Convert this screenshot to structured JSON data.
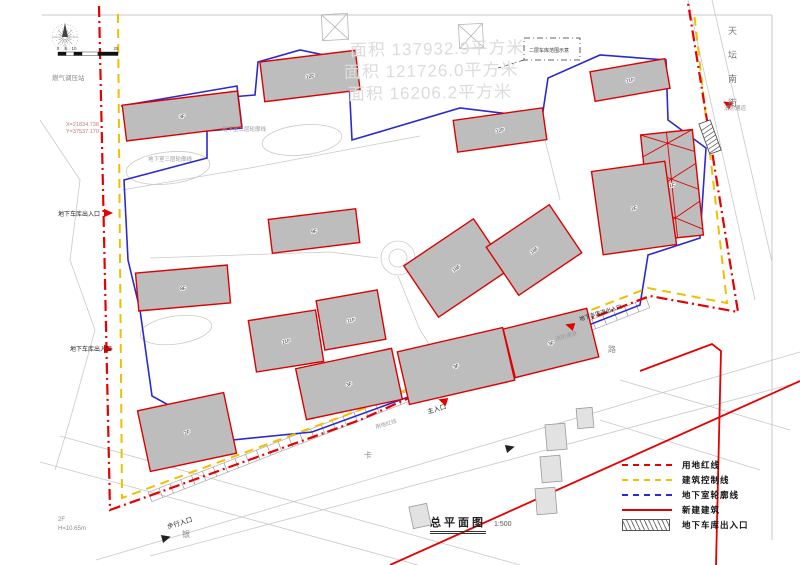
{
  "drawing": {
    "title": "总平面图",
    "scale": "1:500"
  },
  "legend": {
    "items": [
      {
        "label": "用地红线",
        "style": "dash-dot",
        "color": "#e60000"
      },
      {
        "label": "建筑控制线",
        "style": "dashed",
        "color": "#eec000"
      },
      {
        "label": "地下室轮廓线",
        "style": "dashed",
        "color": "#2a2ad0"
      },
      {
        "label": "新建建筑",
        "style": "solid",
        "color": "#e60000"
      },
      {
        "label": "地下车库出入口",
        "style": "hatch",
        "color": "#444444"
      }
    ]
  },
  "compass": {
    "type": "wind-rose"
  },
  "scale_bar": {
    "marks": [
      "0",
      "5",
      "10",
      "25"
    ]
  },
  "streets": {
    "right_vertical": "天坛南街"
  },
  "area_notes": [
    {
      "text": "面积 137932.9平方米",
      "x": 350,
      "y": 56
    },
    {
      "text": "面积 121726.0平方米",
      "x": 344,
      "y": 78
    },
    {
      "text": "面积 16206.2平方米",
      "x": 348,
      "y": 100
    }
  ],
  "labels": [
    {
      "t": "燃气调压站",
      "x": 52,
      "y": 80,
      "s": 6.5,
      "c": "#8a8a8a"
    },
    {
      "t": "X=21834.738",
      "x": 66,
      "y": 126,
      "s": 5.5,
      "c": "#c27b7b"
    },
    {
      "t": "Y=37537.170",
      "x": 66,
      "y": 133,
      "s": 5.5,
      "c": "#c27b7b"
    },
    {
      "t": "地下车库出入口",
      "x": 58,
      "y": 216,
      "s": 6,
      "c": "#222222"
    },
    {
      "t": "地下车库出入口",
      "x": 70,
      "y": 351,
      "s": 6,
      "c": "#222222"
    },
    {
      "t": "地下室二层轮廓线",
      "x": 222,
      "y": 131,
      "s": 5.5,
      "c": "#999999"
    },
    {
      "t": "地下室三层轮廓线",
      "x": 148,
      "y": 161,
      "s": 5.5,
      "c": "#999999"
    },
    {
      "t": "地下车库进出入口",
      "x": 580,
      "y": 321,
      "s": 5.5,
      "c": "#222222",
      "r": -17
    },
    {
      "t": "消防通道",
      "x": 556,
      "y": 341,
      "s": 5.5,
      "c": "#999999",
      "r": -17
    },
    {
      "t": "消防通道",
      "x": 724,
      "y": 110,
      "s": 5.5,
      "c": "#999999"
    },
    {
      "t": "主入口",
      "x": 428,
      "y": 414,
      "s": 6.5,
      "c": "#222222",
      "r": -17
    },
    {
      "t": "用地红线",
      "x": 376,
      "y": 429,
      "s": 5.5,
      "c": "#999999",
      "r": -17
    },
    {
      "t": "步行入口",
      "x": 168,
      "y": 529,
      "s": 6.5,
      "c": "#222222",
      "r": -17
    },
    {
      "t": "2F",
      "x": 58,
      "y": 521,
      "s": 6,
      "c": "#8a8a8a"
    },
    {
      "t": "H=10.65m",
      "x": 58,
      "y": 530,
      "s": 6,
      "c": "#8a8a8a"
    },
    {
      "t": "二层车库范围示意",
      "x": 529,
      "y": 52,
      "s": 5,
      "c": "#333333"
    },
    {
      "t": "用地红线",
      "x": 74,
      "y": 300,
      "s": 0,
      "c": "#999999"
    },
    {
      "t": "路",
      "x": 608,
      "y": 352,
      "s": 8,
      "c": "#8a8a8a"
    },
    {
      "t": "卡",
      "x": 364,
      "y": 458,
      "s": 8,
      "c": "#8a8a8a"
    },
    {
      "t": "银",
      "x": 182,
      "y": 537,
      "s": 8,
      "c": "#8a8a8a"
    }
  ],
  "buildings": [
    {
      "cx": 182,
      "cy": 116,
      "w": 116,
      "h": 36,
      "rot": -7,
      "label": "3F"
    },
    {
      "cx": 310,
      "cy": 76,
      "w": 96,
      "h": 40,
      "rot": -7,
      "label": "12F"
    },
    {
      "cx": 500,
      "cy": 130,
      "w": 90,
      "h": 32,
      "rot": -8,
      "label": "12F"
    },
    {
      "cx": 630,
      "cy": 80,
      "w": 76,
      "h": 30,
      "rot": -10,
      "label": "11F"
    },
    {
      "cx": 672,
      "cy": 185,
      "w": 52,
      "h": 106,
      "rot": -6,
      "label": "1F",
      "hatch": true
    },
    {
      "cx": 634,
      "cy": 208,
      "w": 74,
      "h": 84,
      "rot": -8,
      "label": "2F"
    },
    {
      "cx": 183,
      "cy": 288,
      "w": 92,
      "h": 38,
      "rot": -5,
      "label": "8F"
    },
    {
      "cx": 314,
      "cy": 231,
      "w": 88,
      "h": 34,
      "rot": -7,
      "label": "9F"
    },
    {
      "cx": 456,
      "cy": 268,
      "w": 84,
      "h": 62,
      "rot": -34,
      "label": "18F"
    },
    {
      "cx": 534,
      "cy": 250,
      "w": 76,
      "h": 58,
      "rot": -34,
      "label": "18F"
    },
    {
      "cx": 351,
      "cy": 320,
      "w": 62,
      "h": 50,
      "rot": -10,
      "label": "11F"
    },
    {
      "cx": 286,
      "cy": 341,
      "w": 68,
      "h": 52,
      "rot": -9,
      "label": "11F"
    },
    {
      "cx": 349,
      "cy": 384,
      "w": 98,
      "h": 52,
      "rot": -12,
      "label": "3F"
    },
    {
      "cx": 456,
      "cy": 366,
      "w": 108,
      "h": 54,
      "rot": -13,
      "label": "3F"
    },
    {
      "cx": 551,
      "cy": 343,
      "w": 86,
      "h": 50,
      "rot": -14,
      "label": "3F"
    },
    {
      "cx": 187,
      "cy": 432,
      "w": 88,
      "h": 62,
      "rot": -12,
      "label": "2F"
    }
  ],
  "context_buildings": [
    {
      "cx": 556,
      "cy": 437,
      "w": 20,
      "h": 26,
      "rot": -5
    },
    {
      "cx": 551,
      "cy": 469,
      "w": 20,
      "h": 26,
      "rot": -5
    },
    {
      "cx": 546,
      "cy": 501,
      "w": 20,
      "h": 26,
      "rot": -5
    },
    {
      "cx": 420,
      "cy": 516,
      "w": 18,
      "h": 22,
      "rot": -12
    },
    {
      "cx": 585,
      "cy": 418,
      "w": 16,
      "h": 20,
      "rot": -5
    }
  ],
  "colors": {
    "building_fill": "#bdbdbd",
    "building_stroke": "#dd0000",
    "red_line": "#e60000",
    "yellow_line": "#eec000",
    "blue_line": "#2a2ad0",
    "context_line": "#c9c9c9",
    "text_gray": "#8a8a8a"
  }
}
